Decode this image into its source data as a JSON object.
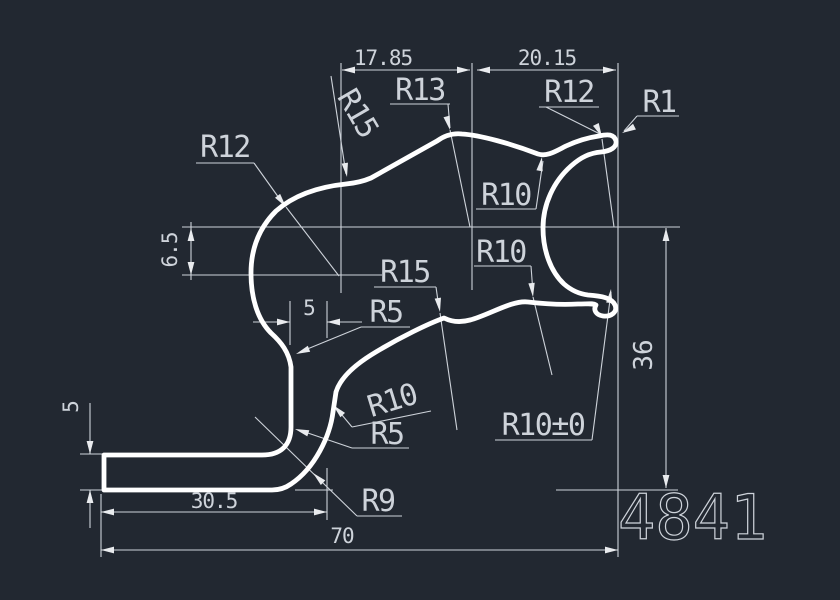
{
  "part_number": "4841",
  "colors": {
    "background": "#222831",
    "profile": "#ffffff",
    "annotation": "#ced3da"
  },
  "dims": {
    "top_left_width": "17.85",
    "top_right_width": "20.15",
    "upper_offset": "6.5",
    "overall_height": "36",
    "leg_thickness": "5",
    "wall_thickness": "5",
    "leg_length": "30.5",
    "overall_width": "70"
  },
  "radii": {
    "r13": "R13",
    "r15_top": "R15",
    "r12_left": "R12",
    "r12_right": "R12",
    "r1": "R1",
    "r10_upper": "R10",
    "r10_lower": "R10",
    "r15_mid": "R15",
    "r5_upper": "R5",
    "r10_mid": "R10",
    "r5_lower": "R5",
    "r9": "R9",
    "r10_tol": "R10±0"
  }
}
